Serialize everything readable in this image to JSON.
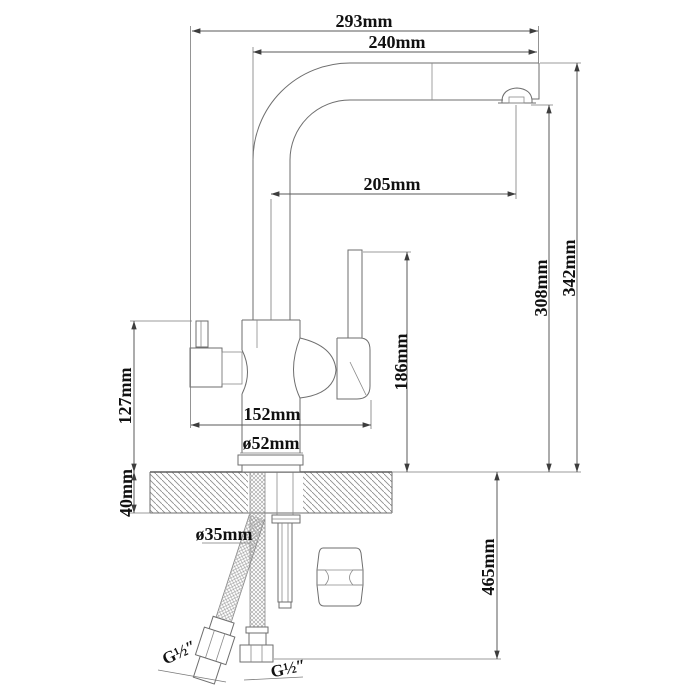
{
  "labels": {
    "d293": "293mm",
    "d240": "240mm",
    "d205": "205mm",
    "d342": "342mm",
    "d308": "308mm",
    "d186": "186mm",
    "d152": "152mm",
    "d127": "127mm",
    "d52": "ø52mm",
    "d40": "40mm",
    "d35": "ø35mm",
    "d465": "465mm",
    "g_left": "G½″",
    "g_right": "G½″"
  }
}
